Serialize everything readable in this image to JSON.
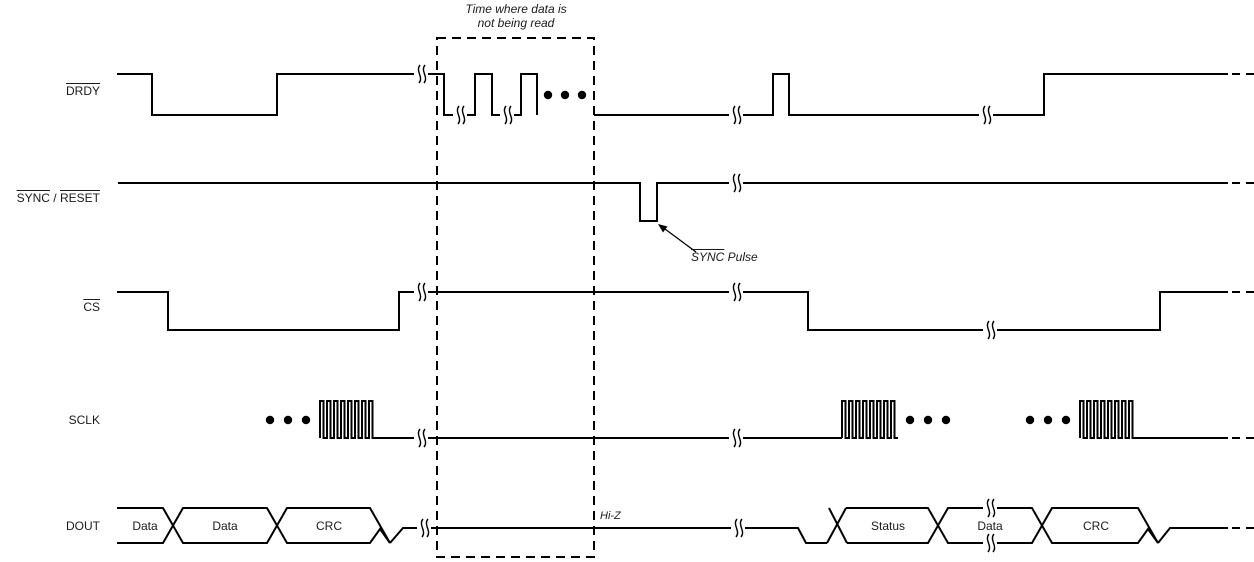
{
  "title": {
    "line1": "Time where data is",
    "line2": "not being read"
  },
  "signals": {
    "drdy": {
      "label": "DRDY"
    },
    "sync_reset": {
      "part1": "SYNC",
      "separator": " / ",
      "part2": "RESET"
    },
    "cs": {
      "label": "CS"
    },
    "sclk": {
      "label": "SCLK"
    },
    "dout": {
      "label": "DOUT"
    }
  },
  "annotations": {
    "sync_pulse": {
      "word": "SYNC",
      "rest": " Pulse"
    },
    "hi_z": "Hi-Z"
  },
  "bus": {
    "left": [
      "Data",
      "Data",
      "CRC"
    ],
    "right": [
      "Status",
      "Data",
      "CRC"
    ]
  },
  "colors": {
    "line": "#000000",
    "text": "#1b1b1b",
    "background": "#ffffff"
  }
}
